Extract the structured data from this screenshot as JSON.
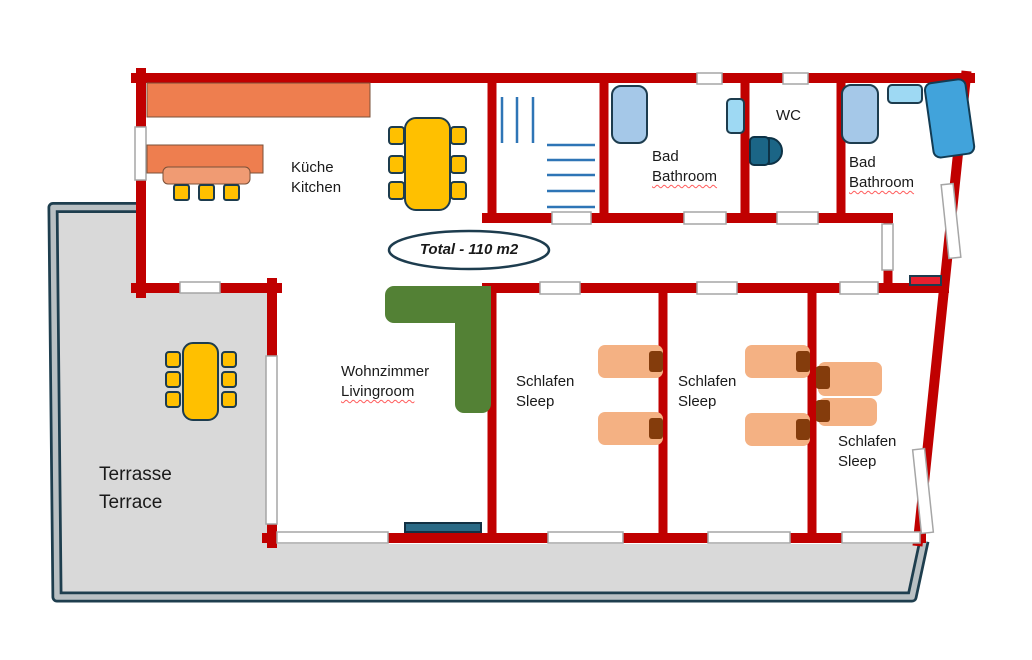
{
  "page": {
    "width": 1032,
    "height": 660,
    "background": "#ffffff"
  },
  "annotation": {
    "total_area": "Total - 110 m2"
  },
  "rooms": {
    "kitchen": {
      "name_de": "Küche",
      "name_en": "Kitchen"
    },
    "bathroom_left": {
      "name_de": "Bad",
      "name_en": "Bathroom"
    },
    "wc": {
      "name": "WC"
    },
    "bathroom_right": {
      "name_de": "Bad",
      "name_en": "Bathroom"
    },
    "living_room": {
      "name_de": "Wohnzimmer",
      "name_en": "Livingroom"
    },
    "bedroom_1": {
      "name_de": "Schlafen",
      "name_en": "Sleep"
    },
    "bedroom_2": {
      "name_de": "Schlafen",
      "name_en": "Sleep"
    },
    "bedroom_3": {
      "name_de": "Schlafen",
      "name_en": "Sleep"
    },
    "terrace": {
      "name_de": "Terrasse",
      "name_en": "Terrace"
    }
  },
  "colors": {
    "wall": "#C00000",
    "terrace_floor": "#D9D9D9",
    "terrace_rail_dark": "#1E3E4E",
    "terrace_rail_light": "#B9C0C3",
    "opening_outline": "#A6A6A6",
    "kitchen_counter": "#EE7E4F",
    "kitchen_island": "#F09B73",
    "table_chair_yellow": "#FFC000",
    "sofa_green": "#538135",
    "bed_salmon": "#F4B183",
    "pillow_brown": "#843C0C",
    "shower_blue": "#A5C8E8",
    "sink_blue": "#9ED9F3",
    "bathtub_blue": "#41A3DB",
    "toilet_teal": "#1B6586",
    "stairs_blue": "#2E75B6",
    "tv_teal": "#2A6A86",
    "radiator_red": "#E8202E",
    "text": "#1A1A1A"
  }
}
